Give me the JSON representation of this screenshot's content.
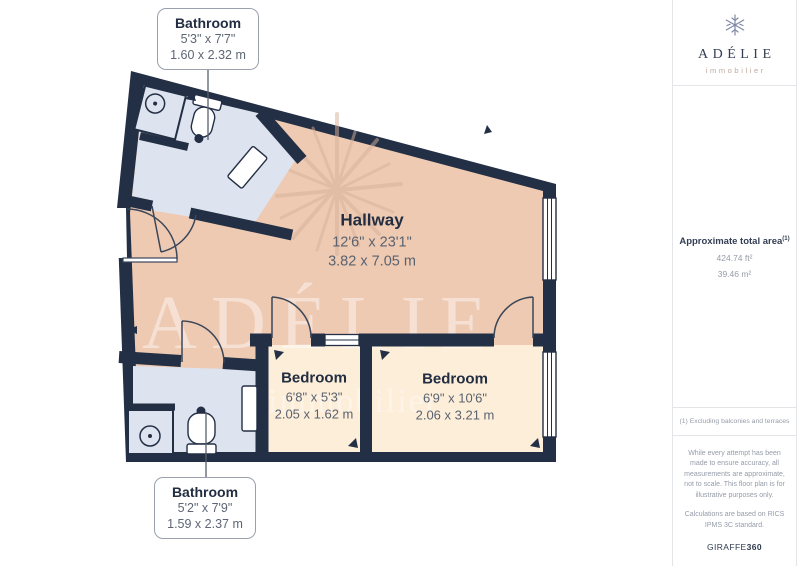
{
  "brand": {
    "name": "ADÉLIE",
    "tagline": "immobilier"
  },
  "sidebar": {
    "area_label": "Approximate total area",
    "area_note_ref": "(1)",
    "area_imperial": "424.74 ft²",
    "area_metric": "39.46 m²",
    "footnote": "(1) Excluding balconies and terraces",
    "disclaimer": "While every attempt has been made to ensure accuracy, all measurements are approximate, not to scale. This floor plan is for illustrative purposes only.",
    "standard_note": "Calculations are based on RICS IPMS 3C standard.",
    "provider": "GIRAFFE",
    "provider_suffix": "360"
  },
  "floorplan": {
    "rooms": {
      "hallway": {
        "name": "Hallway",
        "dimensions_imperial": "12'6\" x 23'1\"",
        "dimensions_metric": "3.82 x 7.05 m"
      },
      "bedroom_small": {
        "name": "Bedroom",
        "dimensions_imperial": "6'8\" x 5'3\"",
        "dimensions_metric": "2.05 x 1.62 m"
      },
      "bedroom_large": {
        "name": "Bedroom",
        "dimensions_imperial": "6'9\" x 10'6\"",
        "dimensions_metric": "2.06 x 3.21 m"
      },
      "bathroom_top": {
        "name": "Bathroom",
        "dimensions_imperial": "5'3\" x 7'7\"",
        "dimensions_metric": "1.60 x 2.32 m"
      },
      "bathroom_bottom": {
        "name": "Bathroom",
        "dimensions_imperial": "5'2\" x 7'9\"",
        "dimensions_metric": "1.59 x 2.37 m"
      }
    },
    "colors": {
      "wall": "#232f45",
      "hallway_floor": "#eecab3",
      "bedroom_floor": "#fdeeda",
      "bathroom_floor": "#dde3ef",
      "background": "#ffffff",
      "label_primary": "#222d41",
      "label_secondary": "#5d6674",
      "logo_blue": "#7f8aa8",
      "tagline_tan": "#bfa99c"
    }
  }
}
